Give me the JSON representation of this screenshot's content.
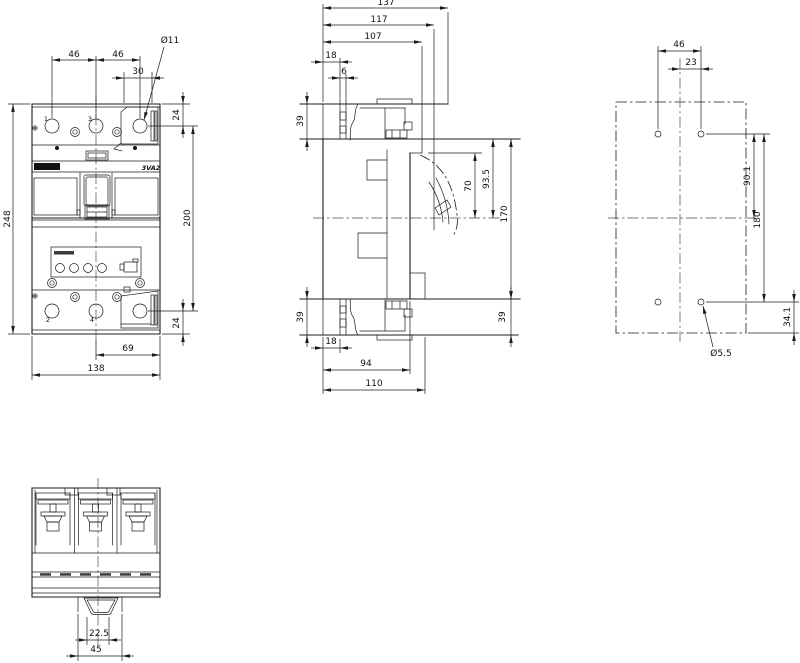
{
  "drawing": {
    "product_label": "3VA2",
    "front": {
      "dim_46_left": "46",
      "dim_46_right": "46",
      "dim_30": "30",
      "dia_11": "Ø11",
      "dim_24_top": "24",
      "dim_200": "200",
      "dim_24_bottom": "24",
      "dim_248": "248",
      "dim_69": "69",
      "dim_138": "138",
      "terminal_1": "1",
      "terminal_3": "3",
      "terminal_2": "2",
      "terminal_4": "4"
    },
    "side": {
      "dim_137": "137",
      "dim_117": "117",
      "dim_107": "107",
      "dim_18_top": "18",
      "dim_6": "6",
      "dim_39_top_left": "39",
      "dim_39_bottom_left": "39",
      "dim_70": "70",
      "dim_93_5": "93.5",
      "dim_170": "170",
      "dim_39_bottom_right": "39",
      "dim_18_bottom": "18",
      "dim_94": "94",
      "dim_110": "110"
    },
    "rear": {
      "dim_46": "46",
      "dim_23": "23",
      "dim_90_1": "90.1",
      "dim_180": "180",
      "dim_34_1": "34.1",
      "dia_5_5": "Ø5.5"
    },
    "bottom": {
      "dim_22_5": "22.5",
      "dim_45": "45"
    }
  }
}
